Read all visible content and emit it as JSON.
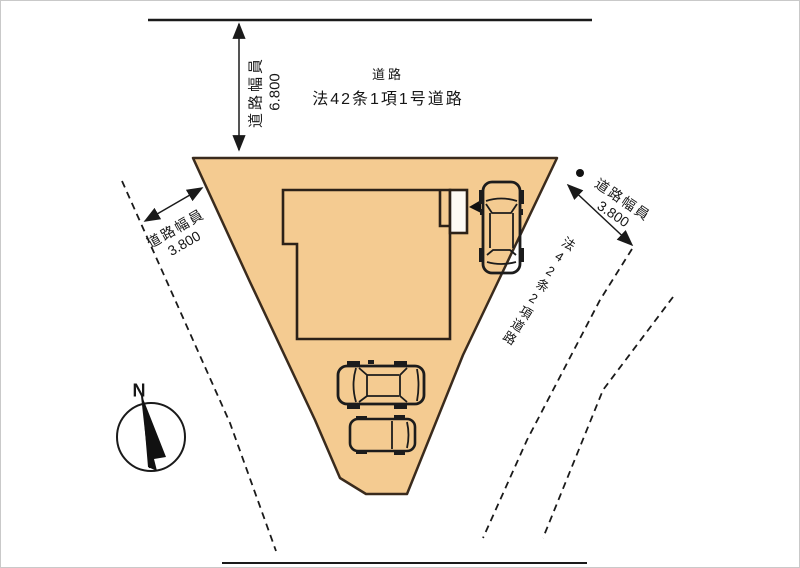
{
  "plan": {
    "top_road": {
      "name_line1": "道路",
      "name_line2": "法42条1項1号道路",
      "width_label": "道路幅員",
      "width_value": "6.800"
    },
    "left_road": {
      "width_label": "道路幅員",
      "width_value": "3.800"
    },
    "right_road": {
      "width_label": "道路幅員",
      "width_value": "3.800",
      "name": "法42条2項道路"
    },
    "compass": {
      "north": "N"
    },
    "colors": {
      "lot_fill": "#f4cb91",
      "lot_outline": "#3a2b1d",
      "line": "#1a1a1a"
    }
  }
}
